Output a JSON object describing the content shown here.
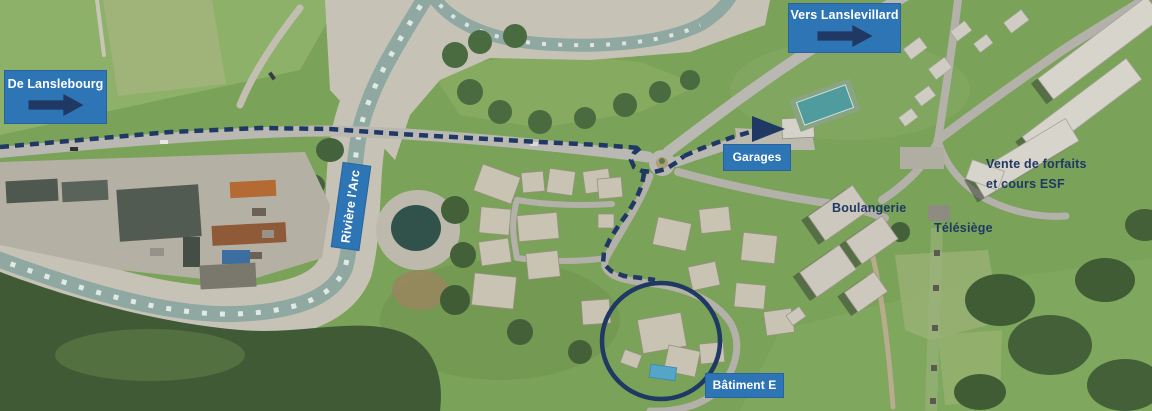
{
  "map": {
    "type": "annotated-aerial-photo",
    "signs": {
      "de_lanslebourg": {
        "label": "De Lanslebourg"
      },
      "vers_lanslevillard": {
        "label": "Vers Lanslevillard"
      },
      "garages": {
        "label": "Garages"
      },
      "batiment_e": {
        "label": "Bâtiment E"
      },
      "riviere_larc": {
        "label": "Rivière l'Arc"
      }
    },
    "place_labels": {
      "boulangerie": "Boulangerie",
      "telesiege": "Télésiège",
      "vente_forfaits_line1": "Vente de forfaits",
      "vente_forfaits_line2": "et cours ESF"
    },
    "route": {
      "style": "dashed",
      "description": "driving route from Lanslebourg road to Bâtiment E",
      "highlighted_building": "Bâtiment E"
    },
    "icons": {
      "direction_arrow": "right-arrow",
      "route_arrowhead": "right-arrowhead",
      "highlight": "circle-outline"
    },
    "colors": {
      "sign_background": "#2e75b6",
      "sign_text": "#ffffff",
      "annotation_navy": "#1f3864"
    }
  }
}
